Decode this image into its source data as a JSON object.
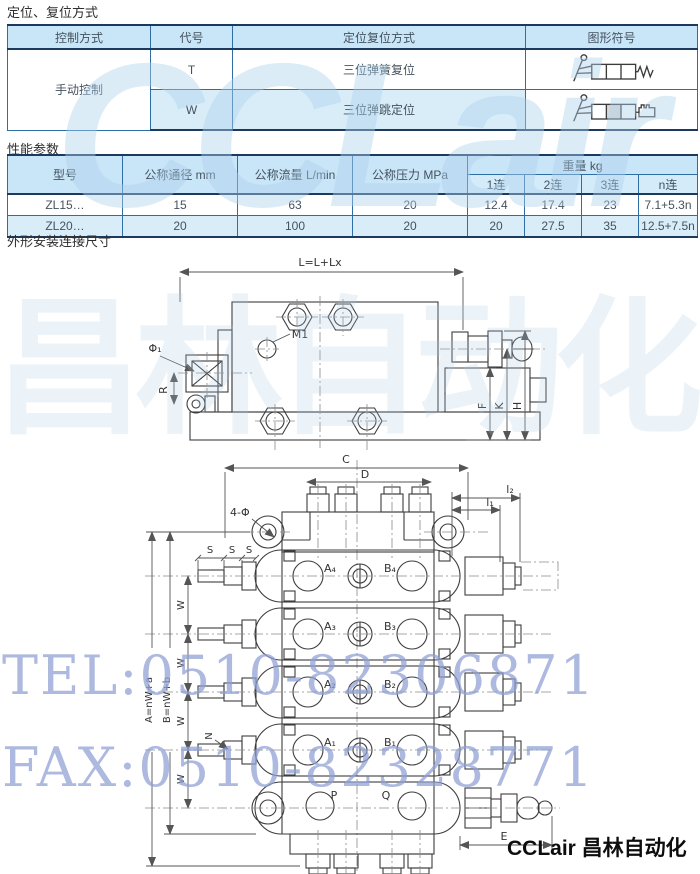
{
  "page": {
    "section1_title": "定位、复位方式",
    "section2_title": "性能参数",
    "section3_title": "外形安装连接尺寸",
    "footer_logo": "CCLair 昌林自动化"
  },
  "colors": {
    "table_header_blue": "#c9e5f8",
    "table_row_blue": "#d9edf9",
    "table_border": "#1b3a5e",
    "watermark_blue": "#8e9fd4"
  },
  "watermark": {
    "logo_text": "CCLair",
    "logo_cn": "昌林自动化",
    "tel": "TEL:0510-82306871",
    "fax": "FAX:0510-82328771"
  },
  "control_table": {
    "headers": [
      "控制方式",
      "代号",
      "定位复位方式",
      "图形符号"
    ],
    "control_method": "手动控制",
    "rows": [
      {
        "code": "T",
        "method": "三位弹簧复位",
        "symbol": "lever-3pos-spring-return-symbol"
      },
      {
        "code": "W",
        "method": "三位弹跳定位",
        "symbol": "lever-3pos-detent-symbol"
      }
    ]
  },
  "performance_table": {
    "headers": [
      "型号",
      "公称通径 mm",
      "公称流量 L/min",
      "公称压力 MPa"
    ],
    "weight_header": "重量 kg",
    "weight_subheaders": [
      "1连",
      "2连",
      "3连",
      "n连"
    ],
    "rows": [
      {
        "model": "ZL15…",
        "diameter": "15",
        "flow": "63",
        "pressure": "20",
        "w1": "12.4",
        "w2": "17.4",
        "w3": "23",
        "wn": "7.1+5.3n"
      },
      {
        "model": "ZL20…",
        "diameter": "20",
        "flow": "100",
        "pressure": "20",
        "w1": "20",
        "w2": "27.5",
        "w3": "35",
        "wn": "12.5+7.5n"
      }
    ]
  },
  "drawing": {
    "labels": {
      "total_length": "L=L+Lx",
      "m1": "M1",
      "phi": "Φ₁",
      "r": "R",
      "f": "F",
      "k": "K",
      "h": "H",
      "c": "C",
      "d": "D",
      "l2": "l₂",
      "l1": "l₁",
      "four_phi": "4-Φ",
      "s": "S",
      "w": "W",
      "n": "N",
      "a_formula": "A=nW+a",
      "b_formula": "B=nW+b",
      "a4": "A₄",
      "b4": "B₄",
      "a3": "A₃",
      "b3": "B₃",
      "a2": "A₂",
      "b2": "B₂",
      "a1": "A₁",
      "b1": "B₁",
      "p": "P",
      "q": "Q",
      "e": "E"
    }
  }
}
